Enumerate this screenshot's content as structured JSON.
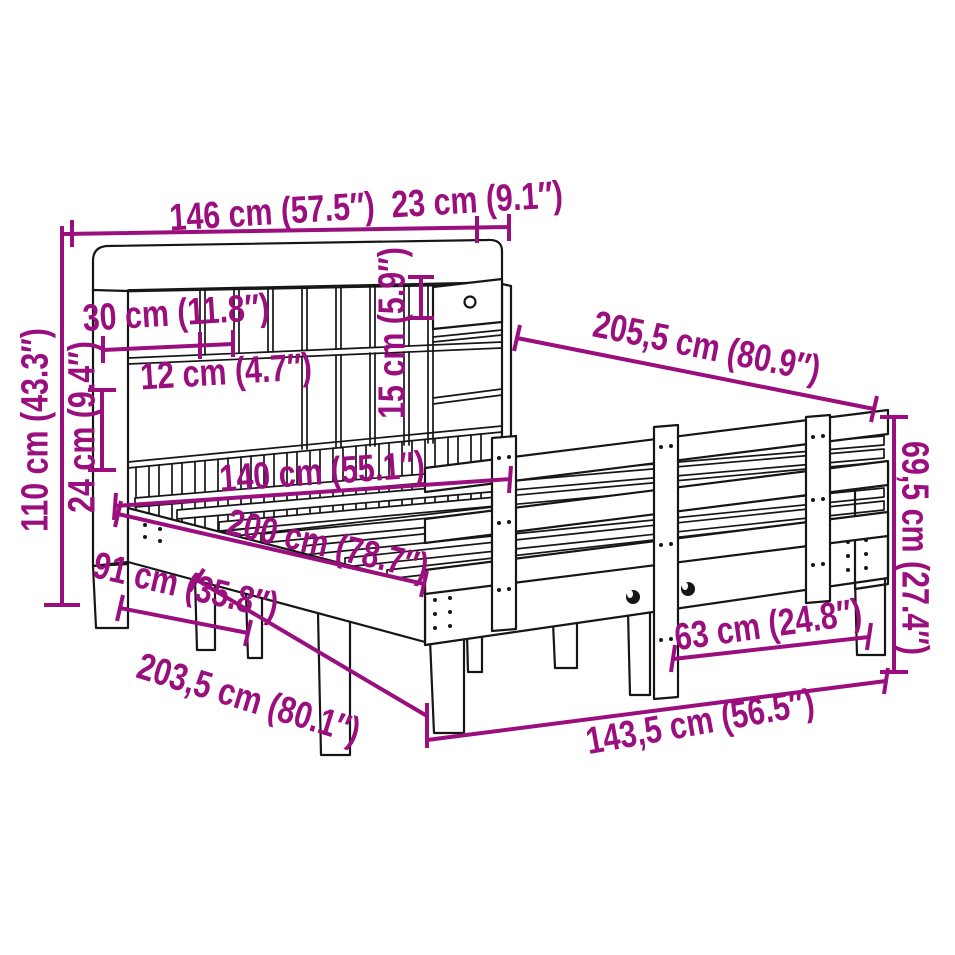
{
  "colors": {
    "dimension": "#9A0E7E",
    "line_art": "#161616",
    "background": "#FFFFFF"
  },
  "dimensions": [
    {
      "name": "headboard-width",
      "label": "146 cm (57.5″)"
    },
    {
      "name": "headboard-top-depth",
      "label": "23 cm (9.1″)"
    },
    {
      "name": "headboard-height",
      "label": "110 cm (43.3″)"
    },
    {
      "name": "slat-panel-height",
      "label": "24 cm (9.4″)"
    },
    {
      "name": "shelf-compartment-width",
      "label": "30 cm (11.8″)"
    },
    {
      "name": "cubby-width",
      "label": "12 cm (4.7″)"
    },
    {
      "name": "drawer-height",
      "label": "15 cm (5.9″)"
    },
    {
      "name": "total-length",
      "label": "205,5 cm (80.9″)"
    },
    {
      "name": "inner-width",
      "label": "140 cm (55.1″)"
    },
    {
      "name": "inner-length",
      "label": "200 cm (78.7″)"
    },
    {
      "name": "headboard-base-span",
      "label": "91 cm (35.8″)"
    },
    {
      "name": "base-length",
      "label": "203,5 cm (80.1″)"
    },
    {
      "name": "side-rail-length",
      "label": "143,5 cm (56.5″)"
    },
    {
      "name": "rail-post-spacing",
      "label": "63 cm (24.8″)"
    },
    {
      "name": "side-rail-height",
      "label": "69,5 cm (27.4″)"
    }
  ]
}
